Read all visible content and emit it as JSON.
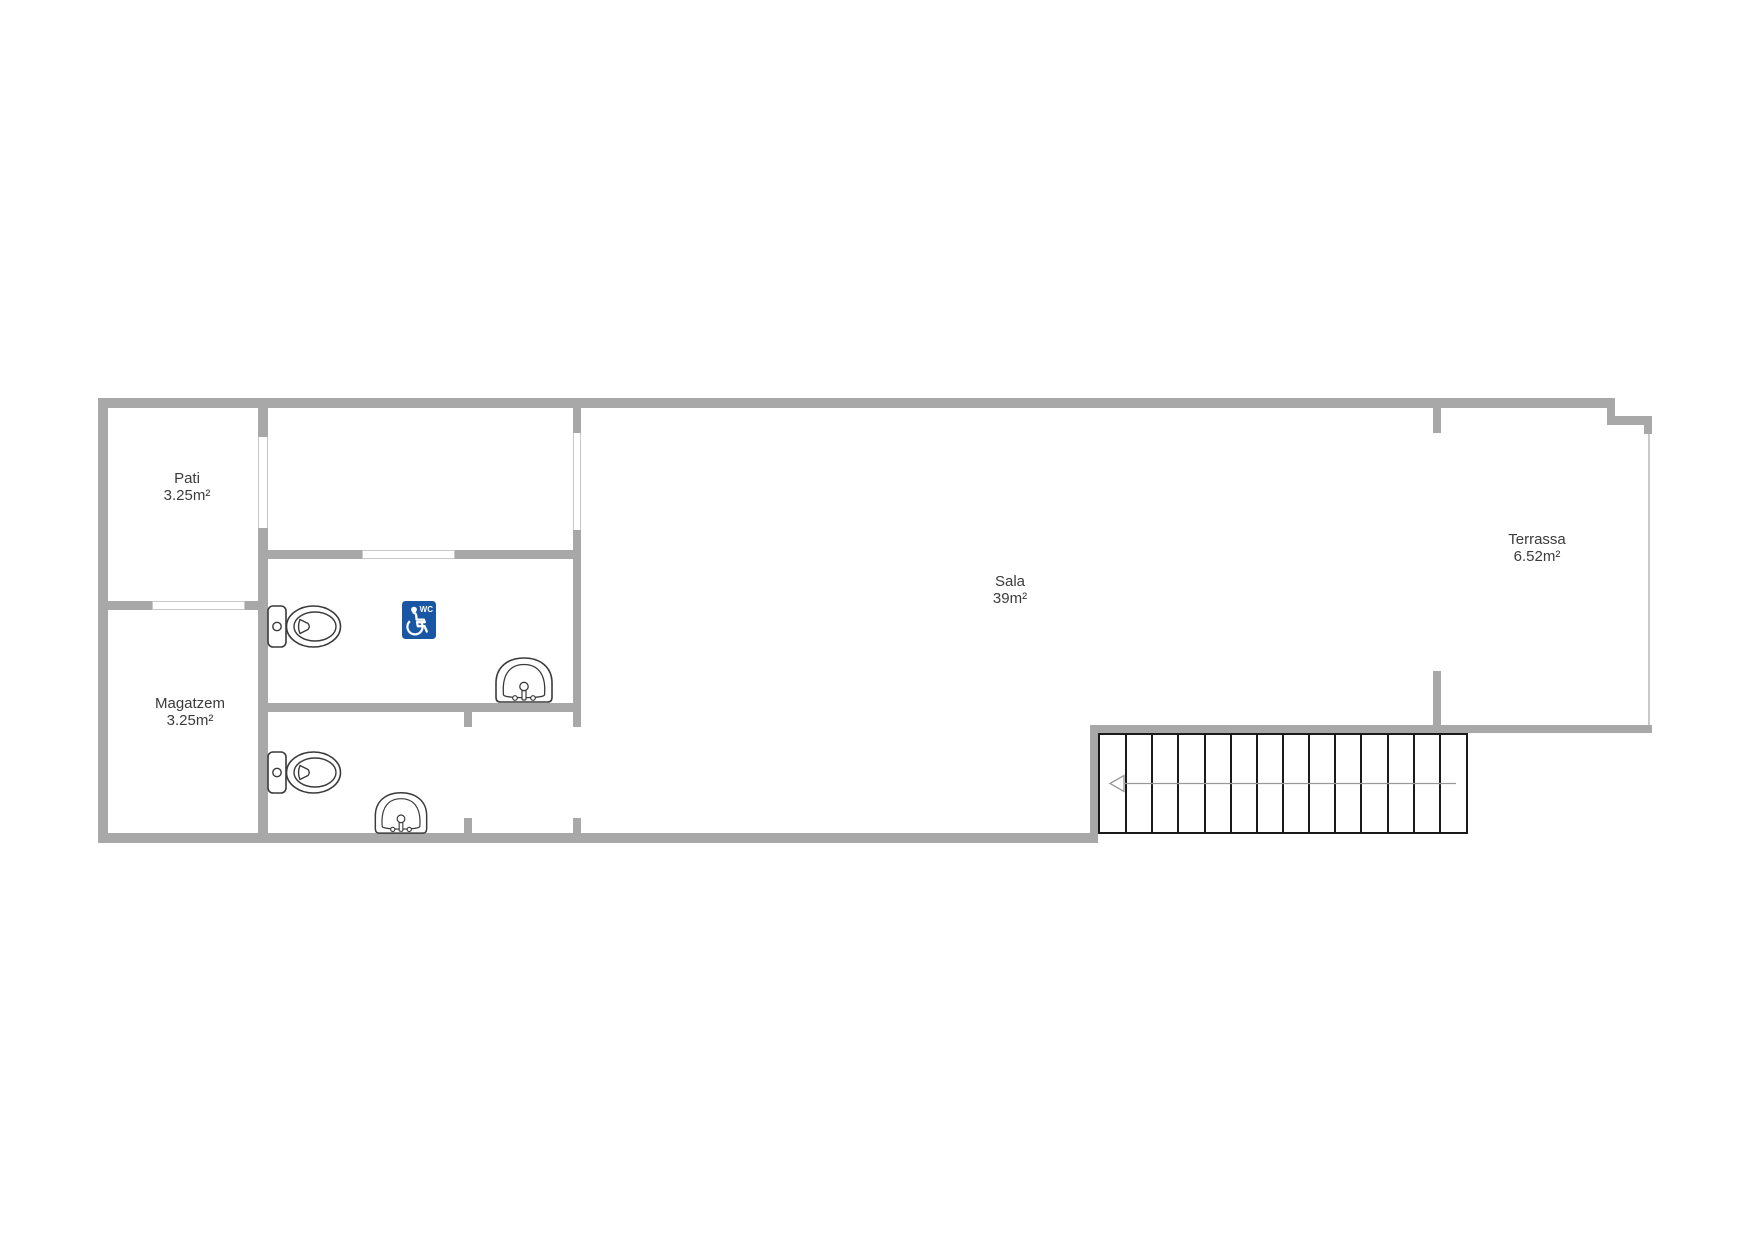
{
  "document": {
    "type": "floor-plan",
    "background": "#ffffff"
  },
  "colors": {
    "wall": "#a8a8a8",
    "wall_light": "#c9c9c9",
    "fixture": "#3a3a3a",
    "stair": "#1a1a1a",
    "arrow": "#999999",
    "text": "#3b3b3b",
    "sign_blue": "#1956a4",
    "sign_glyph": "#ffffff"
  },
  "rooms": [
    {
      "name": "Pati",
      "area": "3.25m²"
    },
    {
      "name": "Magatzem",
      "area": "3.25m²"
    },
    {
      "name": "Sala",
      "area": "39m²"
    },
    {
      "name": "Terrassa",
      "area": "6.52m²"
    }
  ],
  "accessible_sign": {
    "label": "WC"
  },
  "stairs": {
    "treads": 14,
    "arrow_direction": "left"
  },
  "fixtures": {
    "toilets": 2,
    "sinks": 2,
    "accessible_wc_signs": 1
  }
}
